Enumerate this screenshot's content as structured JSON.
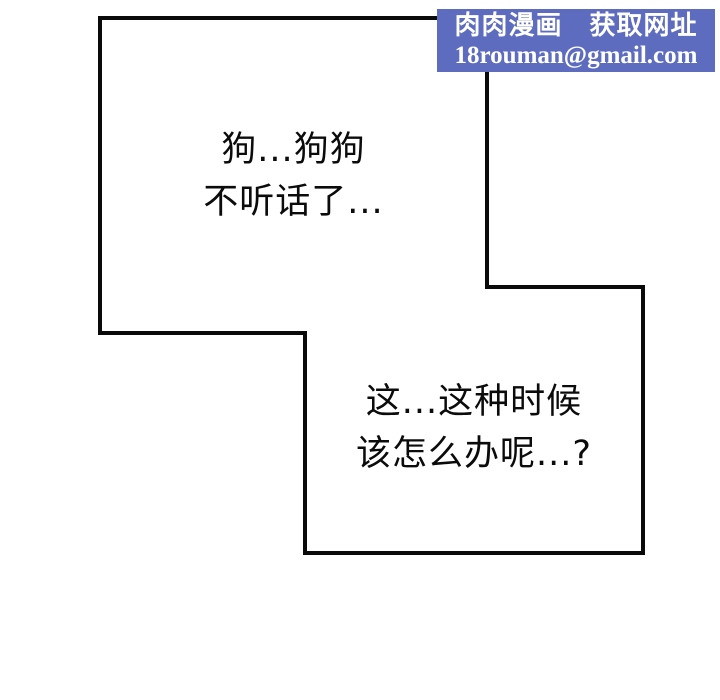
{
  "colors": {
    "background": "#ffffff",
    "outline": "#0a0a0a",
    "text": "#0b0b0b",
    "watermark_bg": "#5d6cbe",
    "watermark_text": "#ffffff"
  },
  "panels": {
    "first": {
      "line1": "狗...狗狗",
      "line2": "不听话了..."
    },
    "second": {
      "line1": "这...这种时候",
      "line2": "该怎么办呢...?"
    }
  },
  "watermark": {
    "title": "肉肉漫画　获取网址",
    "email": "18rouman@gmail.com"
  }
}
